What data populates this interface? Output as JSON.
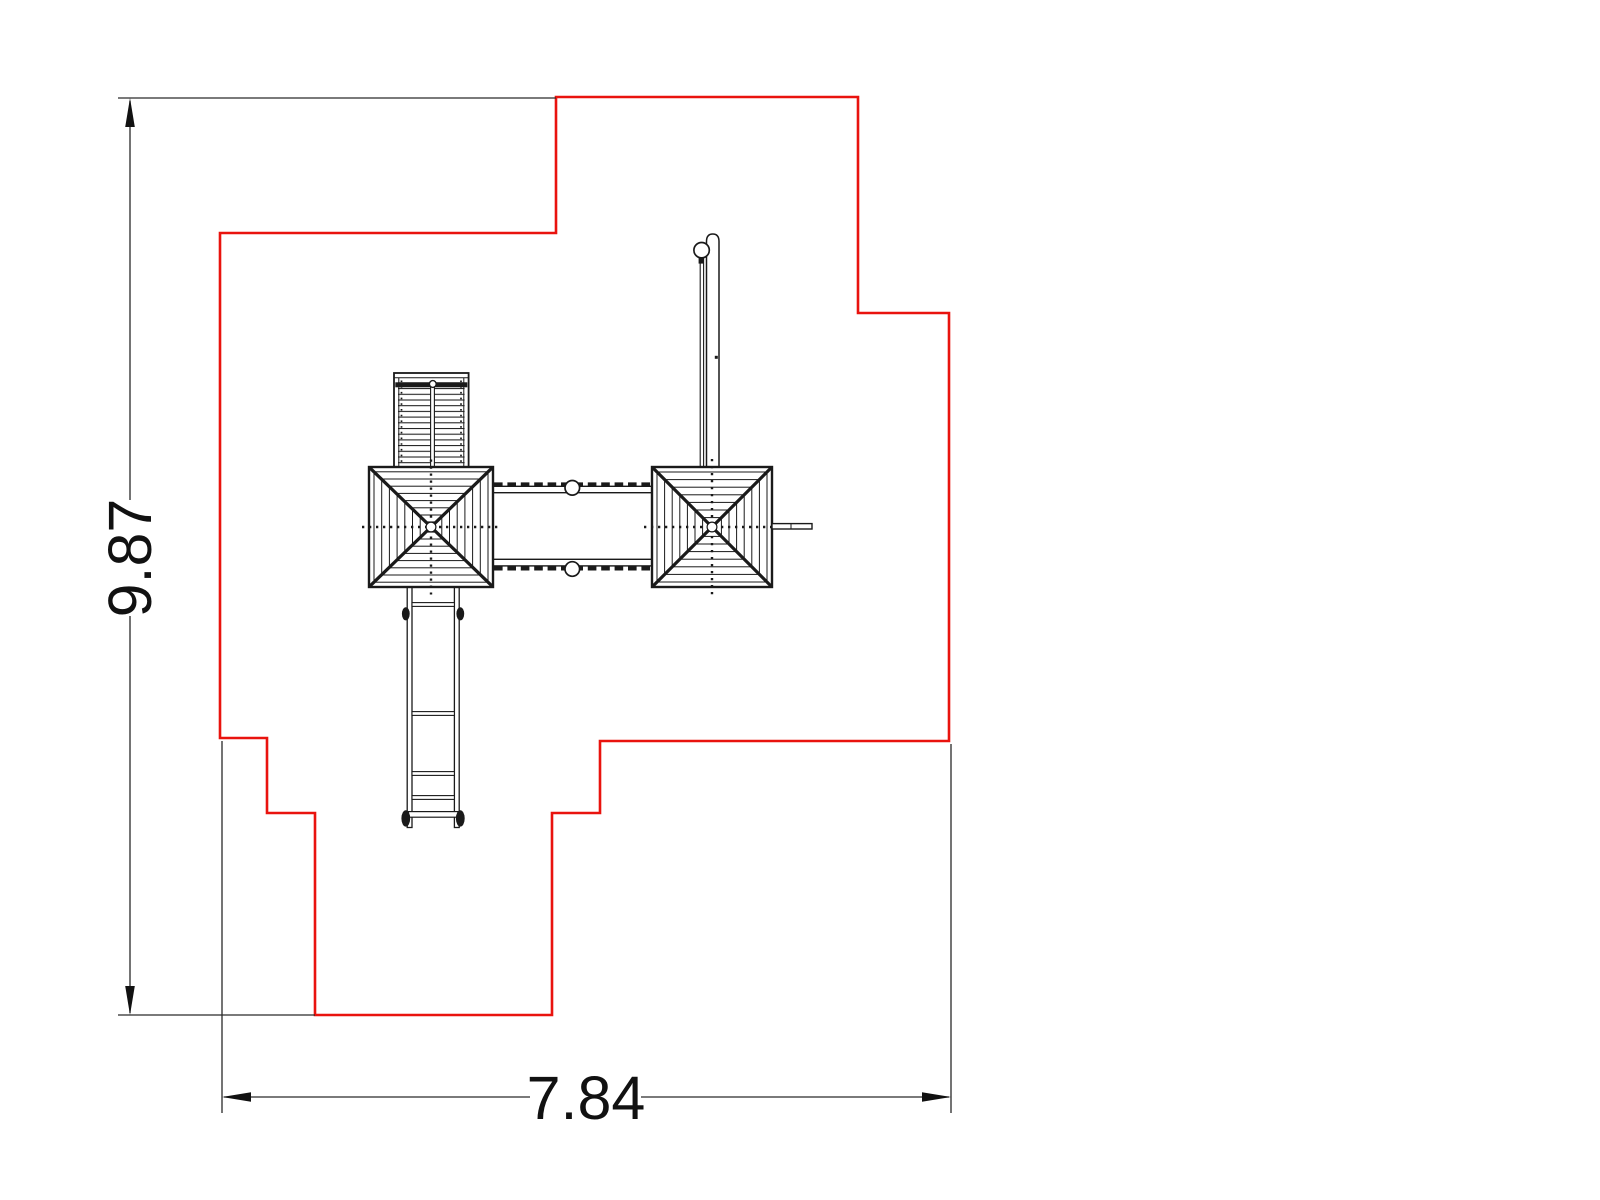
{
  "canvas": {
    "width": 1600,
    "height": 1200,
    "background": "#ffffff"
  },
  "drawing": {
    "description": "Top-view CAD plan of a playground tower set with safety-zone boundary outline",
    "boundary": {
      "color": "#e9130e",
      "points": "556,97 858,97 858,313 949,313 949,741 600,741 600,813 552,813 552,1015 315,1015 315,813 267,813 267,738 220,738 220,233 556,233"
    },
    "line_color": "#1a1a1a",
    "dimensions": {
      "height": {
        "label": "9.87",
        "orientation": "vertical"
      },
      "width": {
        "label": "7.84",
        "orientation": "horizontal"
      }
    },
    "components": [
      "left-tower-roof",
      "right-tower-roof",
      "bridge",
      "climbing-ramp",
      "slide-ladder",
      "swing-pole",
      "side-bar"
    ]
  }
}
